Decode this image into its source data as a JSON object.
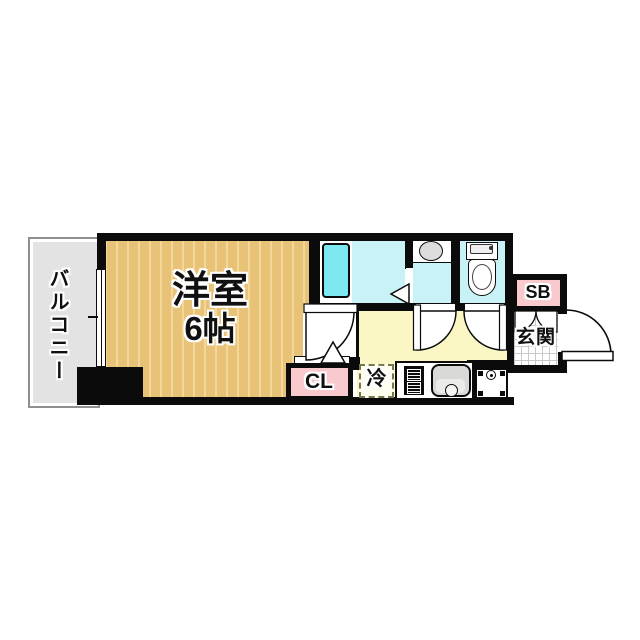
{
  "plan_type": "apartment-floor-plan",
  "labels": {
    "balcony": "バルコニー",
    "room_name": "洋室",
    "room_size": "6帖",
    "closet": "CL",
    "fridge": "冷",
    "shoebox": "SB",
    "entrance": "玄関"
  },
  "rooms": [
    {
      "id": "balcony",
      "label": "バルコニー"
    },
    {
      "id": "western-room",
      "label": "洋室 6帖"
    },
    {
      "id": "bathroom",
      "label": ""
    },
    {
      "id": "washroom",
      "label": ""
    },
    {
      "id": "toilet",
      "label": ""
    },
    {
      "id": "kitchen-hall",
      "label": ""
    },
    {
      "id": "closet",
      "label": "CL"
    },
    {
      "id": "fridge-space",
      "label": "冷"
    },
    {
      "id": "shoebox",
      "label": "SB"
    },
    {
      "id": "entrance",
      "label": "玄関"
    }
  ],
  "colors": {
    "wall": "#0b0b0b",
    "room-floor": "#e8c276",
    "room-stripe": "#f3d89a",
    "hall-floor": "#faf7c5",
    "wet-floor": "#c9f2f6",
    "bathtub": "#7de8ef",
    "pink-box": "#f8c9cd",
    "balcony": "#e3e3e3",
    "fixture-gray": "#d9d9d7"
  }
}
